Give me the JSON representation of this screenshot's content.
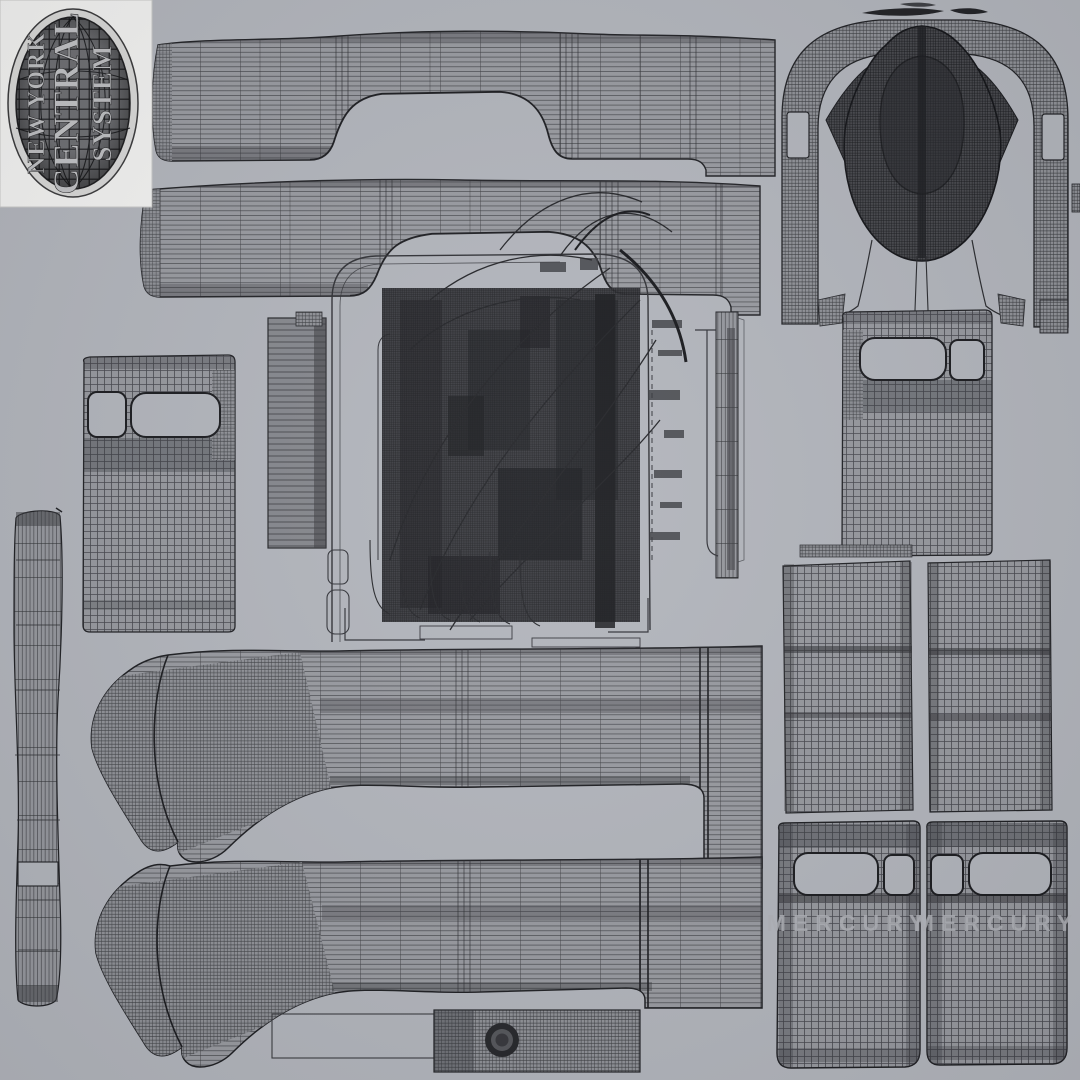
{
  "meta": {
    "description": "UV wireframe texture atlas of a streamlined locomotive 3D model",
    "background_color": "#b2b5bc",
    "wire_color": "#26272b",
    "piece_fill": "#97999f",
    "dark_mesh_fill": "#3c3d42",
    "card_color": "#f2f2f1",
    "light_text_color": "#b7b9be"
  },
  "logo": {
    "line1": "NEW YORK",
    "line2": "CENTRAL",
    "line3": "SYSTEM"
  },
  "panels": {
    "mercury_left": "MERCURY",
    "mercury_right": "MERCURY"
  },
  "pieces": [
    {
      "name": "logo-badge"
    },
    {
      "name": "fender-strip-top"
    },
    {
      "name": "fender-strip-second"
    },
    {
      "name": "nose-horseshoe-band"
    },
    {
      "name": "nose-teardrop-mesh"
    },
    {
      "name": "cab-window-panel-left"
    },
    {
      "name": "cab-window-panel-right"
    },
    {
      "name": "trim-ladder-strip"
    },
    {
      "name": "left-pilot-strip"
    },
    {
      "name": "central-mechanical-cluster"
    },
    {
      "name": "skirt-piece-upper"
    },
    {
      "name": "skirt-piece-lower"
    },
    {
      "name": "side-grid-panel-left"
    },
    {
      "name": "side-grid-panel-right"
    },
    {
      "name": "mercury-door-panel-left"
    },
    {
      "name": "mercury-door-panel-right"
    },
    {
      "name": "headlight-bar"
    }
  ]
}
